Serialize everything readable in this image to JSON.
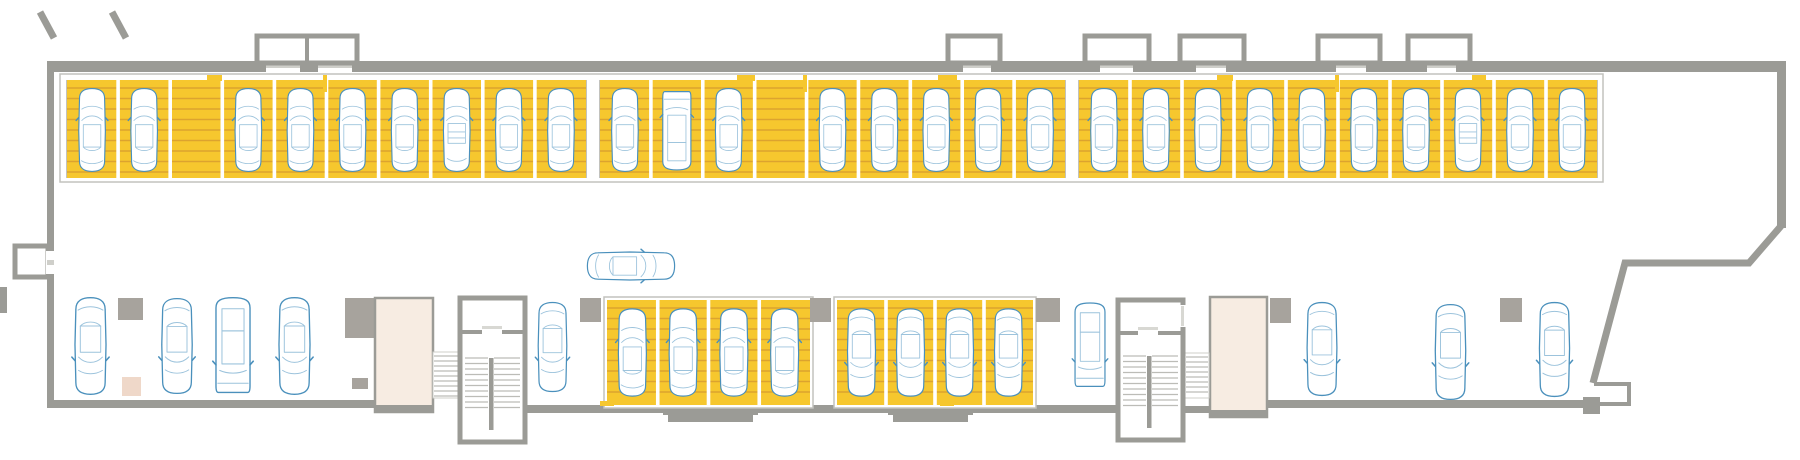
{
  "canvas": {
    "w": 1800,
    "h": 460
  },
  "colors": {
    "bg": "#ffffff",
    "wall": "#9b9b96",
    "wall_light": "#cfcfca",
    "column": "#a7a39d",
    "stall_fill": "#f6c72e",
    "deck_line": "#dca32f",
    "band_border": "#c2c2bd",
    "tread_line": "#bcbcb7",
    "elevator_fill": "#f7ece2",
    "pink_block": "#efd8c9",
    "door_leaf": "#d8d8d3",
    "car_outer": "#4a90bc",
    "car_inner": "#9cc3dc"
  },
  "top_row": {
    "band": {
      "x": 60,
      "y": 74,
      "w": 1543,
      "h": 108
    },
    "stall_top": 80,
    "stall_h": 98,
    "groups": [
      {
        "x": 66,
        "w": 521,
        "stalls": [
          "car",
          "car",
          "empty",
          "car",
          "car",
          "car",
          "car",
          "cabrio",
          "car",
          "car"
        ]
      },
      {
        "x": 599,
        "w": 467,
        "stalls": [
          "car",
          "van",
          "car",
          "empty",
          "car",
          "car",
          "car",
          "car",
          "car"
        ]
      },
      {
        "x": 1078,
        "w": 520,
        "stalls": [
          "car",
          "car",
          "car",
          "car",
          "car",
          "car",
          "car",
          "cabrio",
          "car",
          "car"
        ]
      }
    ],
    "tabs": [
      {
        "x": 207,
        "w": 15
      },
      {
        "x": 737,
        "w": 18
      },
      {
        "x": 938,
        "w": 19
      },
      {
        "x": 1217,
        "w": 16
      },
      {
        "x": 1472,
        "w": 14
      }
    ],
    "ticks": [
      {
        "x": 325
      },
      {
        "x": 805
      },
      {
        "x": 1337
      }
    ]
  },
  "bottom_groups": [
    {
      "x": 607,
      "y": 300,
      "w": 203,
      "h": 105,
      "rot": 0,
      "stalls": [
        "car",
        "car",
        "car",
        "car"
      ]
    },
    {
      "x": 837,
      "y": 300,
      "w": 196,
      "h": 105,
      "rot": 180,
      "stalls": [
        "car",
        "car",
        "car",
        "car"
      ]
    }
  ],
  "free_vehicles": [
    {
      "x": 68,
      "y": 295,
      "w": 45,
      "h": 102,
      "type": "car",
      "rot": 180
    },
    {
      "x": 155,
      "y": 296,
      "w": 44,
      "h": 100,
      "type": "car",
      "rot": 180
    },
    {
      "x": 210,
      "y": 293,
      "w": 46,
      "h": 106,
      "type": "van",
      "rot": 180
    },
    {
      "x": 272,
      "y": 295,
      "w": 45,
      "h": 102,
      "type": "car",
      "rot": 180
    },
    {
      "x": 531,
      "y": 300,
      "w": 43,
      "h": 94,
      "type": "car",
      "rot": 180
    },
    {
      "x": 1068,
      "y": 299,
      "w": 44,
      "h": 93,
      "type": "van",
      "rot": 180
    },
    {
      "x": 1300,
      "y": 300,
      "w": 44,
      "h": 98,
      "type": "car",
      "rot": 180
    },
    {
      "x": 1428,
      "y": 302,
      "w": 45,
      "h": 100,
      "type": "car",
      "rot": 180
    },
    {
      "x": 1532,
      "y": 300,
      "w": 45,
      "h": 99,
      "type": "car",
      "rot": 180
    }
  ],
  "aisle_vehicle": {
    "cx": 631,
    "cy": 266,
    "w": 44,
    "h": 92,
    "type": "car",
    "rot": 90
  },
  "columns": [
    [
      118,
      298,
      25,
      22
    ],
    [
      345,
      298,
      30,
      40
    ],
    [
      352,
      378,
      16,
      11
    ],
    [
      580,
      298,
      21,
      24
    ],
    [
      810,
      298,
      21,
      24
    ],
    [
      1036,
      298,
      24,
      24
    ],
    [
      1270,
      298,
      21,
      25
    ],
    [
      1500,
      298,
      22,
      24
    ]
  ],
  "pink_blocks": [
    [
      122,
      377,
      19,
      19
    ]
  ],
  "elevators": [
    {
      "x": 375,
      "y": 298,
      "w": 58,
      "h": 114
    },
    {
      "x": 1210,
      "y": 297,
      "w": 57,
      "h": 120
    }
  ],
  "stairwells": [
    {
      "x": 460,
      "y": 298,
      "w": 65,
      "h": 144,
      "divider_y": 332,
      "flight_top": 358,
      "flight_bottom": 412,
      "mid": 491,
      "door_gap": [
        482,
        502
      ]
    },
    {
      "x": 1118,
      "y": 300,
      "w": 65,
      "h": 140,
      "divider_y": 333,
      "flight_top": 356,
      "flight_bottom": 410,
      "mid": 1149,
      "door_gap": [
        1138,
        1158
      ],
      "side_door": [
        1179,
        305,
        8,
        22
      ]
    }
  ],
  "straight_flights": [
    {
      "x": 433,
      "y": 352,
      "w": 28,
      "h": 46
    },
    {
      "x": 1185,
      "y": 353,
      "w": 24,
      "h": 45
    }
  ],
  "bays": [
    {
      "x": 257,
      "y": 36,
      "w": 100,
      "h": 27,
      "divider": 307
    },
    {
      "x": 948,
      "y": 36,
      "w": 52,
      "h": 27
    },
    {
      "x": 1085,
      "y": 36,
      "w": 64,
      "h": 27
    },
    {
      "x": 1180,
      "y": 36,
      "w": 64,
      "h": 27
    },
    {
      "x": 1318,
      "y": 36,
      "w": 62,
      "h": 27
    },
    {
      "x": 1408,
      "y": 36,
      "w": 62,
      "h": 27
    }
  ],
  "walls": {
    "top": {
      "x": 47,
      "y": 61,
      "w": 1739,
      "h": 11
    },
    "top_gaps": [
      [
        266,
        34
      ],
      [
        318,
        34
      ],
      [
        963,
        28
      ],
      [
        1100,
        33
      ],
      [
        1196,
        30
      ],
      [
        1336,
        30
      ],
      [
        1427,
        29
      ]
    ],
    "left": [
      {
        "x": 47,
        "y": 61,
        "w": 7,
        "h": 191
      },
      {
        "x": 47,
        "y": 274,
        "w": 7,
        "h": 132
      }
    ],
    "left_window": {
      "x": 15,
      "y": 246,
      "w": 33,
      "h": 31,
      "gap": {
        "x": 46,
        "y": 251,
        "w": 9,
        "h": 23
      }
    },
    "left_edge_stub": [
      0,
      287,
      7,
      26
    ],
    "right": {
      "x": 1777,
      "y": 61,
      "w": 9,
      "h": 167
    },
    "right_boundary_path": "M 1781 226 L 1749 263 L 1625 263 L 1593 383",
    "bottom": [
      [
        47,
        400,
        330,
        8
      ],
      [
        523,
        405,
        595,
        8
      ],
      [
        1183,
        406,
        27,
        7
      ],
      [
        1267,
        400,
        320,
        8
      ]
    ],
    "bottom_steps": [
      [
        663,
        408,
        95,
        7
      ],
      [
        668,
        415,
        85,
        7
      ],
      [
        888,
        408,
        85,
        7
      ],
      [
        893,
        415,
        75,
        7
      ]
    ],
    "notch_path": "M 1594 384 L 1629 384 L 1629 404 L 1597 404",
    "end_block": [
      1583,
      397,
      17,
      17
    ],
    "stubs": [
      {
        "x1": 40,
        "y1": 12,
        "x2": 54,
        "y2": 38
      },
      {
        "x1": 112,
        "y1": 12,
        "x2": 126,
        "y2": 38
      }
    ]
  },
  "bottom_tabs": [
    [
      600,
      401,
      14,
      5
    ],
    [
      940,
      401,
      14,
      5
    ]
  ]
}
